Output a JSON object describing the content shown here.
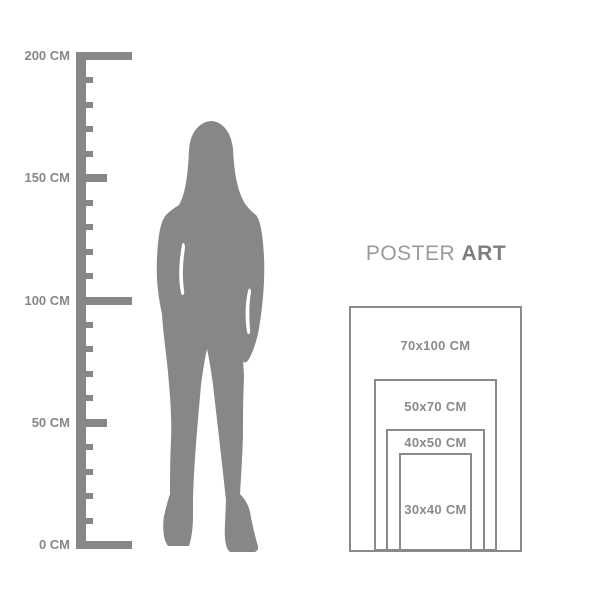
{
  "title": {
    "normal": "POSTER",
    "bold": "ART"
  },
  "ruler": {
    "unit": "CM",
    "max_cm": 200,
    "minor_step_cm": 10,
    "labels": [
      {
        "value": 200,
        "text": "200 CM"
      },
      {
        "value": 150,
        "text": "150 CM"
      },
      {
        "value": 100,
        "text": "100 CM"
      },
      {
        "value": 50,
        "text": "50 CM"
      },
      {
        "value": 0,
        "text": "0 CM"
      }
    ]
  },
  "figure": {
    "icon": "woman-silhouette"
  },
  "poster_sizes": [
    {
      "label": "70x100 CM",
      "width_cm": 70,
      "height_cm": 100
    },
    {
      "label": "50x70 CM",
      "width_cm": 50,
      "height_cm": 70
    },
    {
      "label": "40x50 CM",
      "width_cm": 40,
      "height_cm": 50
    },
    {
      "label": "30x40 CM",
      "width_cm": 30,
      "height_cm": 40
    }
  ],
  "colors": {
    "gray": "#878787",
    "title_normal": "#9a9a9a",
    "title_bold": "#7d7d7d",
    "label": "#8a8a8a",
    "border": "#8a8a8a"
  }
}
